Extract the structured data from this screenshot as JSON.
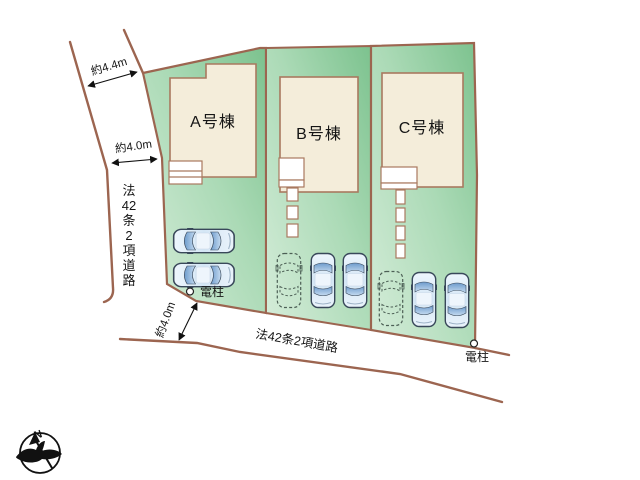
{
  "buildings": [
    {
      "name": "A号棟"
    },
    {
      "name": "B号棟"
    },
    {
      "name": "C号棟"
    }
  ],
  "roads": {
    "left_vertical_chars": [
      "法",
      "42",
      "条",
      "2",
      "項",
      "道",
      "路"
    ],
    "bottom_label": "法42条2項道路"
  },
  "dimensions": {
    "upper_left": "約4.4m",
    "mid_left": "約4.0m",
    "bottom": "約4.0m"
  },
  "poles": {
    "lot_a": "電柱",
    "lot_c": "電柱"
  },
  "compass": {
    "north": "N"
  },
  "colors": {
    "boundary_brown": "#9c6550",
    "lot_green_dark": "#7cc28e",
    "lot_green_light": "#d6edda",
    "building_fill": "#f4edda",
    "building_stroke": "#a9795f",
    "car_window_blue": "#7fa8d4"
  }
}
